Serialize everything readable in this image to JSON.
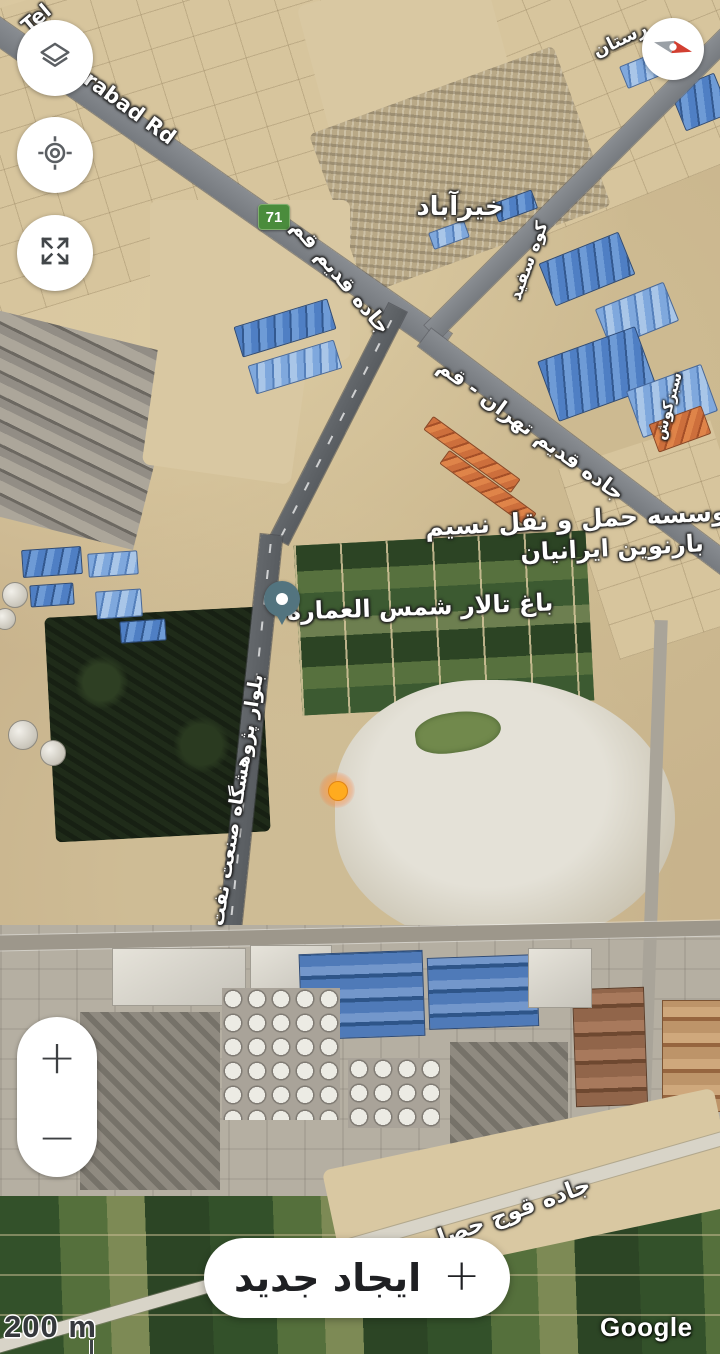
{
  "map": {
    "labels": {
      "road_partial_tel": "Tel",
      "road_orabad": "orabad Rd",
      "route_shield": "71",
      "town_kheyrabad": "خیرآباد",
      "road_jadeh_qadim_qom": "جاده قدیم قم",
      "kuh_sefid": "کوه سفید",
      "road_jadeh_qadim_tehran_qom": "جاده قدیم تهران - قم",
      "sabz_kush": "سبزکوش",
      "partial_rostan": "رستان",
      "company_line1": "موسسه حمل و نقل نسیم",
      "company_line2": "بارنوین ایرانیان",
      "garden_hall": "باغ تالار شمس العماره",
      "blvd_research_oil": "بلوار پژوهشگاه صنعت نفت",
      "road_quch_hesar": "جاده قوج حصار"
    },
    "markers": {
      "place_pin": "teal-place-pin",
      "selected_point": "orange-dot-marker"
    }
  },
  "controls": {
    "layers_icon": "layers-icon",
    "my_location_icon": "my-location-icon",
    "fullscreen_icon": "fullscreen-expand-icon",
    "compass_icon": "compass-needle-icon",
    "zoom_in_label": "+",
    "zoom_out_label": "−"
  },
  "footer": {
    "scale_label": "200 m",
    "watermark": "Google",
    "create_button": {
      "label": "ایجاد جدید",
      "icon": "+"
    }
  },
  "colors": {
    "route_shield_green": "#4a8c3c",
    "pin_teal": "#53747f",
    "selected_marker_orange": "#ffab1f",
    "compass_red": "#d23f31",
    "sand_base": "#c8b38c"
  }
}
